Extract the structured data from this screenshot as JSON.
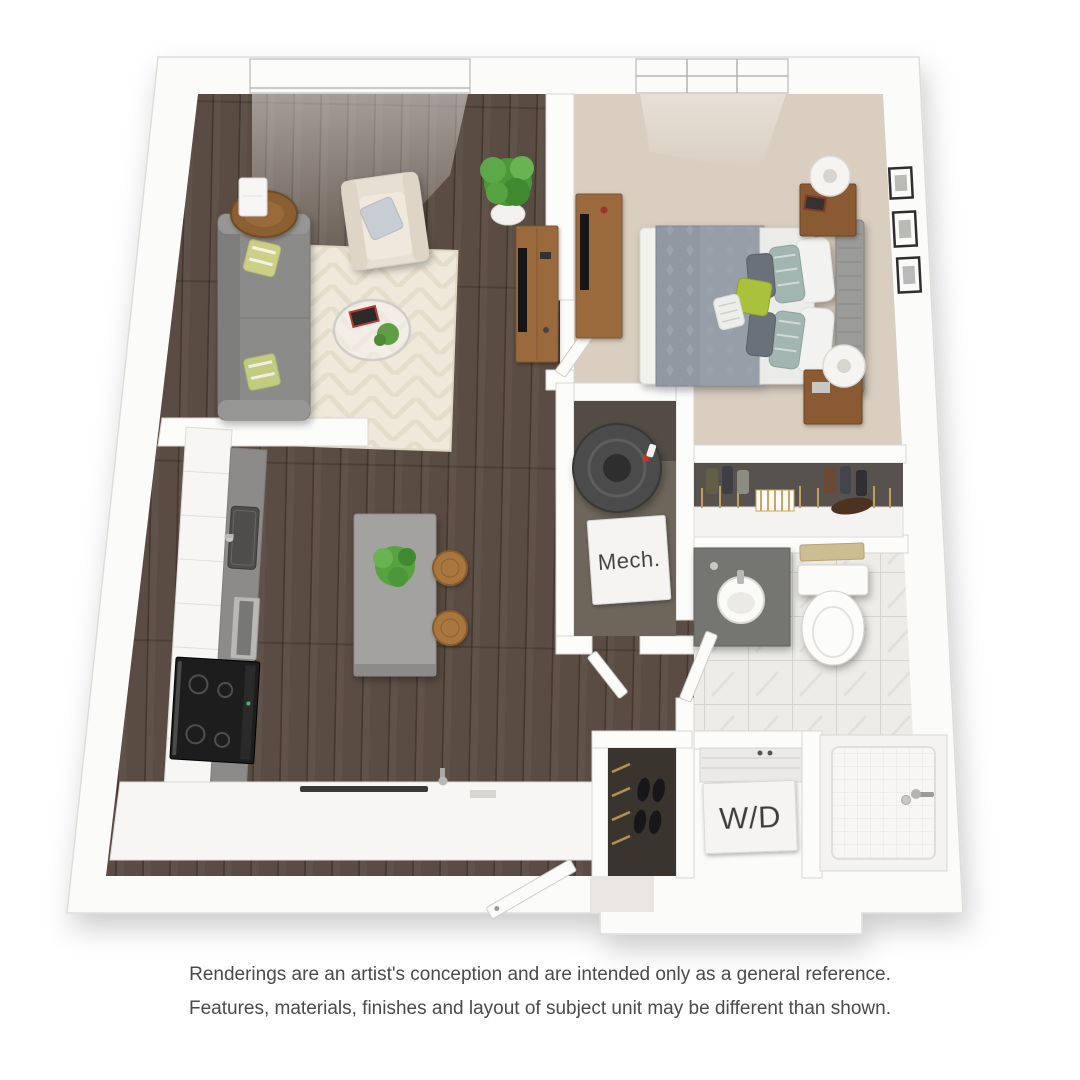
{
  "labels": {
    "mech": "Mech.",
    "washer_dryer": "W/D"
  },
  "disclaimer": {
    "line1": "Renderings are an artist's conception and are intended only as a general reference.",
    "line2": "Features, materials, finishes and layout of subject unit may be different than shown."
  },
  "colors": {
    "background": "#ffffff",
    "wall": "#fbfbfa",
    "wall_stroke": "#d8d6d2",
    "hardwood": "#5a4c42",
    "carpet": "#d9cec0",
    "marble": "#edece9",
    "rug": "#efe9db",
    "sofa": "#8b8b89",
    "armchair": "#e7dfd2",
    "island": "#a3a2a0",
    "counter": "#8c8b89",
    "cabinet": "#f7f6f4",
    "stove": "#1d1d1d",
    "wood_furniture": "#9a6a3c",
    "nightstand_wood": "#8a5a30",
    "bed_duvet": "#9098a1",
    "headboard": "#9b9b99",
    "accent_green": "#a9c13e",
    "plant_green": "#57a33f",
    "vanity": "#757472",
    "water_heater": "#4b4b4b",
    "closet_interior": "#6e665b",
    "entry_closet_interior": "#3a342e",
    "label_text": "#3c3c3c",
    "disclaimer_text": "#4a4a4a"
  }
}
